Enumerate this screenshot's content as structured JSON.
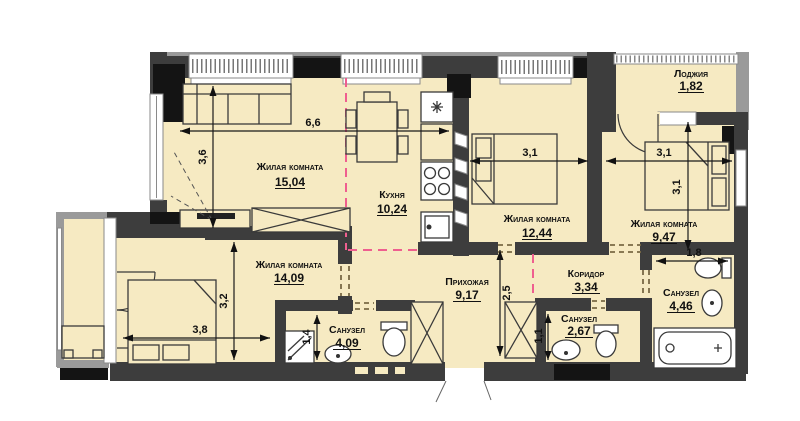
{
  "rooms": {
    "living1": {
      "name": "Жилая комната",
      "area": "15,04"
    },
    "kitchen": {
      "name": "Кухня",
      "area": "10,24"
    },
    "living2": {
      "name": "Жилая комната",
      "area": "12,44"
    },
    "living3": {
      "name": "Жилая комната",
      "area": "9,47"
    },
    "loggia": {
      "name": "Лоджия",
      "area": "1,82"
    },
    "living4": {
      "name": "Жилая комната",
      "area": "14,09"
    },
    "hall": {
      "name": "Прихожая",
      "area": "9,17"
    },
    "corridor": {
      "name": "Коридор",
      "area": "3,34"
    },
    "bath1": {
      "name": "Санузел",
      "area": "4,09"
    },
    "bath2": {
      "name": "Санузел",
      "area": "2,67"
    },
    "bath3": {
      "name": "Санузел",
      "area": "4,46"
    }
  },
  "dims": {
    "living_width": "6,6",
    "living_depth": "3,6",
    "living2_width": "3,1",
    "living3_width": "3,1",
    "living3_depth": "3,1",
    "living4_depth": "3,2",
    "living4_width": "3,8",
    "hall_depth": "2,5",
    "bath1_shower": "1,4",
    "bath2_depth": "1,1",
    "bath3_width": "1,8"
  },
  "colors": {
    "floor": "#f6eac2",
    "wall": "#3d3d3d",
    "wall_accent": "#141414",
    "outer_band": "#9a9a9a",
    "zone_line": "#ef5f8f",
    "opening_line": "#7a6a45"
  }
}
